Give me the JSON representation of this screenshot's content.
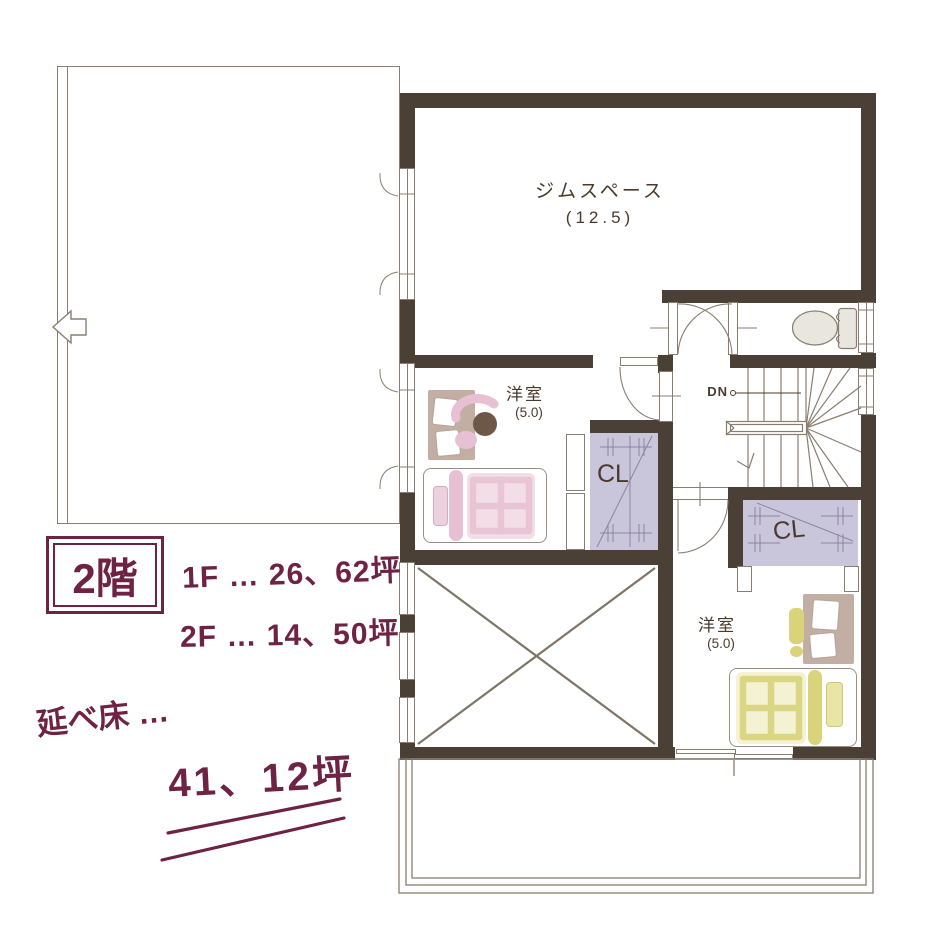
{
  "colors": {
    "wall": "#4b4036",
    "line": "#8a7e71",
    "ink": "#4a3a2c",
    "plum": "#6e2345",
    "lavender": "#c9c6db",
    "lavline": "#8d84a0",
    "pink": "#f3dde7",
    "pink_deep": "#e7c1d3",
    "tan": "#c3aea3",
    "head": "#6d5847",
    "green": "#d9d37b",
    "green_pale": "#f4f2d2",
    "fixture": "#e9e6e0"
  },
  "annotations": {
    "floor_badge": "2階",
    "area_line1": "1F … 26、62坪",
    "area_line2": "2F … 14、50坪",
    "total_label": "延べ床 …",
    "total_value": "41、12坪"
  },
  "rooms": {
    "gym": {
      "name": "ジムスペース",
      "size": "(12.5)"
    },
    "bedroom1": {
      "name": "洋室",
      "size": "(5.0)"
    },
    "bedroom2": {
      "name": "洋室",
      "size": "(5.0)"
    },
    "closet1_label": "CL",
    "closet2_label": "CL",
    "stairs_label": "DN"
  }
}
